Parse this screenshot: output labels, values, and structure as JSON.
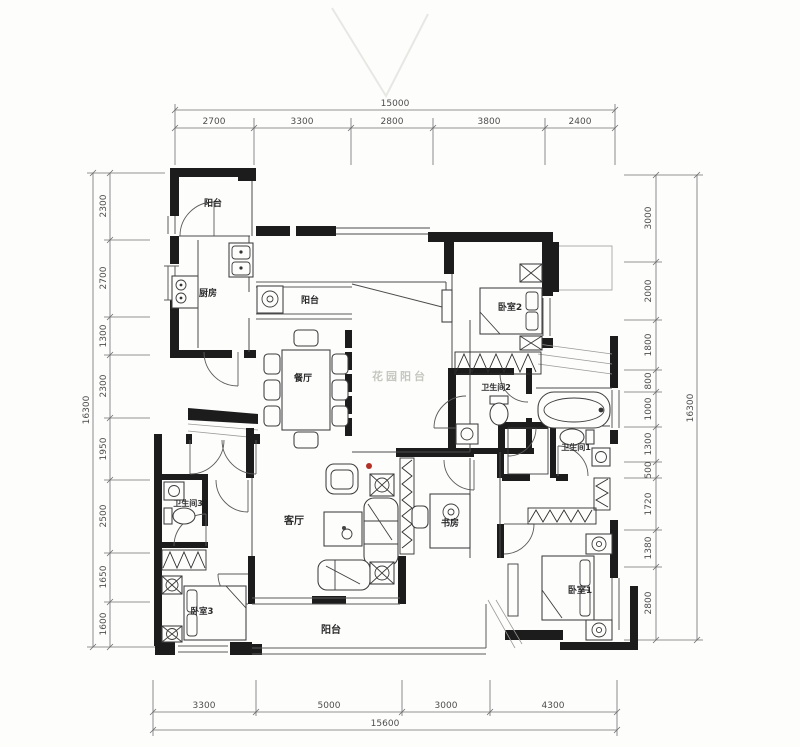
{
  "document": {
    "kind": "apartment-floor-plan"
  },
  "rooms": {
    "balcony_top": "阳台",
    "kitchen": "厨房",
    "balcony_mid": "阳台",
    "bedroom2": "卧室2",
    "dining": "餐厅",
    "garden_balcony": "花园阳台",
    "bath2": "卫生间2",
    "bath1": "卫生间1",
    "bath3": "卫生间3",
    "living": "客厅",
    "study": "书房",
    "bedroom3": "卧室3",
    "bedroom1": "卧室1",
    "balcony_bottom": "阳台"
  },
  "dims": {
    "top": {
      "total": "15000",
      "segments": [
        "2700",
        "3300",
        "2800",
        "3800",
        "2400"
      ]
    },
    "bottom": {
      "total": "15600",
      "segments": [
        "3300",
        "5000",
        "3000",
        "4300"
      ]
    },
    "left": {
      "total": "16300",
      "segments": [
        "2300",
        "2700",
        "1300",
        "2300",
        "1950",
        "2500",
        "1650",
        "1600"
      ]
    },
    "right": {
      "total": "16300",
      "segments": [
        "3000",
        "2000",
        "1800",
        "800",
        "1000",
        "1300",
        "500",
        "1720",
        "1380",
        "2800"
      ]
    }
  },
  "colors": {
    "wall": "#1c1c1c",
    "dim_line": "#6e6e6e",
    "watermark": "#c6c6c0",
    "accent_dot": "#b23228",
    "paper": "#fdfdfc"
  }
}
